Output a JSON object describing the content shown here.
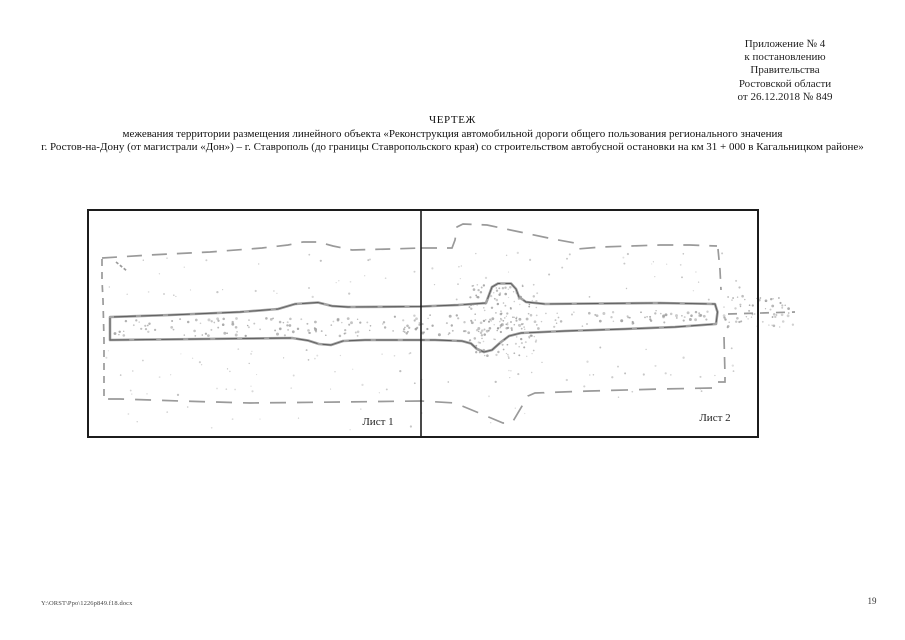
{
  "page": {
    "footer_path": "Y:\\ORST\\Ppo\\1226p849.f18.docx",
    "page_number": "19"
  },
  "header": {
    "appendix_lines": [
      "Приложение № 4",
      "к постановлению",
      "Правительства",
      "Ростовской области",
      "от 26.12.2018 № 849"
    ]
  },
  "title": {
    "line1": "ЧЕРТЕЖ",
    "line2": "межевания территории размещения линейного объекта «Реконструкция автомобильной дороги общего пользования регионального значения",
    "line3": "г. Ростов-на-Дону (от магистрали «Дон») – г. Ставрополь (до границы Ставропольского края) со строительством автобусной остановки на км 31 + 000 в Кагальницком районе»"
  },
  "drawing": {
    "sheet1_label": "Лист 1",
    "sheet2_label": "Лист 2",
    "colors": {
      "frame_border": "#1c1c1c",
      "divider": "#1c1c1c",
      "boundary_dashed": "#9a9a9a",
      "corridor_gray": "#a3a3a3",
      "corridor_dark": "#4d4d4d",
      "noise": "#999999"
    }
  }
}
